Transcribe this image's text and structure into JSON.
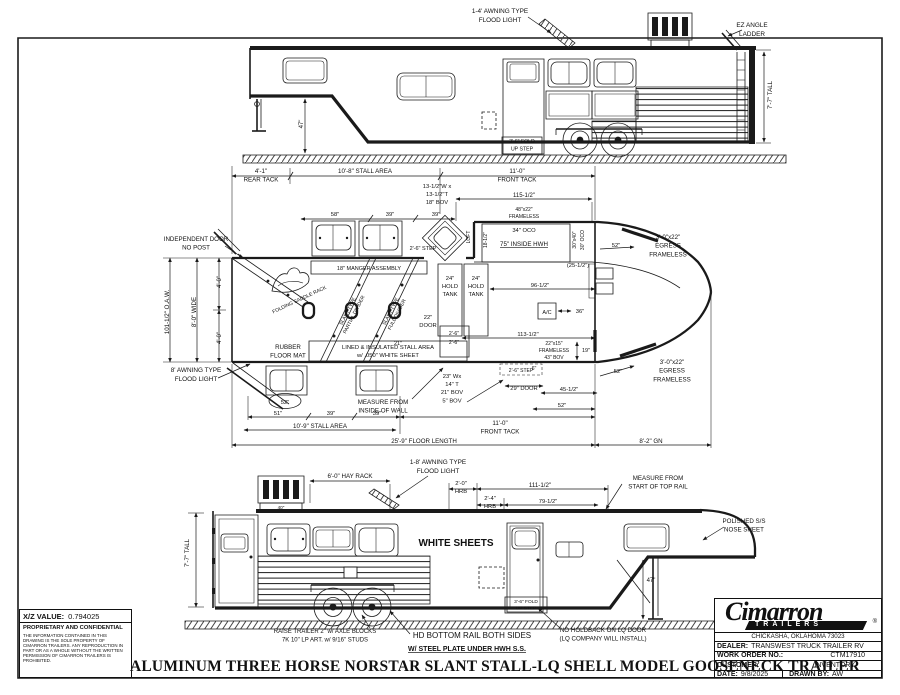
{
  "drawing": {
    "footer_title": "ALUMINUM THREE HORSE NORSTAR SLANT STALL-LQ SHELL MODEL GOOSENECK TRAILER"
  },
  "xz_block": {
    "label": "X/Z VALUE:",
    "value": "0.794025",
    "confidential_title": "PROPRIETARY AND CONFIDENTIAL",
    "confidential_body": "THE INFORMATION CONTAINED IN THIS DRAWING IS THE SOLE PROPERTY OF CIMARRON TRAILERS.  ANY REPRODUCTION IN PART OR AS A WHOLE WITHOUT THE WRITTEN PERMISSION OF CIMARRON TRAILERS IS PROHIBITED."
  },
  "title_block": {
    "brand": "Cimarron",
    "brand_sub": "TRAILERS",
    "registered": "®",
    "address": "CHICKASHA, OKLAHOMA 73023",
    "dealer_label": "DEALER:",
    "dealer": "TRANSWEST TRUCK TRAILER RV",
    "work_order_label": "WORK ORDER NO.:",
    "work_order": "CTM17910",
    "customer_label": "CUSTOMER:",
    "customer": "INVENTORY",
    "date_label": "DATE:",
    "date": "9/8/2025",
    "drawn_by_label": "DRAWN BY:",
    "drawn_by": "AW"
  },
  "annotations": [
    {
      "name": "awning-flood-light-label-top",
      "lines": [
        "1-4' AWNING TYPE",
        "FLOOD LIGHT"
      ],
      "x": 500,
      "y": 13,
      "size": 6.4
    },
    {
      "name": "ez-angle-ladder-label",
      "lines": [
        "EZ ANGLE",
        "LADDER"
      ],
      "x": 752,
      "y": 27,
      "size": 6.4
    },
    {
      "name": "height-dim-top-view",
      "lines": [
        "7'-7\" TALL"
      ],
      "x": 772,
      "y": 95,
      "rot": -90,
      "size": 6.2
    },
    {
      "name": "fold-up-step-label-top-view",
      "lines": [
        "3'-6\" FOLD",
        "UP STEP"
      ],
      "x": 522,
      "y": 143,
      "size": 5.2
    },
    {
      "name": "gooseneck-clearance-dim-top-view",
      "lines": [
        "47\""
      ],
      "x": 303,
      "y": 124,
      "rot": -90,
      "size": 6
    },
    {
      "name": "rear-tack-dim",
      "lines": [
        "4'-1\"",
        "REAR TACK"
      ],
      "x": 261,
      "y": 173,
      "size": 6.2
    },
    {
      "name": "stall-area-dim",
      "lines": [
        "10'-8\" STALL AREA"
      ],
      "x": 365,
      "y": 173,
      "size": 6.2
    },
    {
      "name": "front-tack-dim",
      "lines": [
        "11'-0\"",
        "FRONT TACK"
      ],
      "x": 517,
      "y": 173,
      "size": 6.2
    },
    {
      "name": "loft-window-size-label",
      "lines": [
        "13-1/2\"W x",
        "13-1/2\"T",
        "18\" BOV"
      ],
      "x": 437,
      "y": 188,
      "size": 5.8
    },
    {
      "name": "dim-115-5",
      "lines": [
        "115-1/2\""
      ],
      "x": 524,
      "y": 197,
      "size": 6
    },
    {
      "name": "dim-58",
      "lines": [
        "58\""
      ],
      "x": 335,
      "y": 216,
      "size": 5.8
    },
    {
      "name": "dim-39-a",
      "lines": [
        "39\""
      ],
      "x": 390,
      "y": 216,
      "size": 5.8
    },
    {
      "name": "dim-39-b",
      "lines": [
        "39\""
      ],
      "x": 436,
      "y": 216,
      "size": 5.8
    },
    {
      "name": "hwh-window-label",
      "lines": [
        "48\"x22\"",
        "FRAMELESS"
      ],
      "x": 524,
      "y": 211,
      "size": 5
    },
    {
      "name": "oco-34-label",
      "lines": [
        "34\" OCO"
      ],
      "x": 524,
      "y": 232,
      "size": 5.8
    },
    {
      "name": "inside-hwh-label",
      "lines": [
        "75\" INSIDE HWH"
      ],
      "x": 524,
      "y": 246,
      "size": 6.2,
      "underline": true
    },
    {
      "name": "hwh-right-size-label",
      "lines": [
        "30\"x40\""
      ],
      "x": 576,
      "y": 240,
      "rot": -90,
      "size": 5
    },
    {
      "name": "hwh-right-oco-label",
      "lines": [
        "30\" OCO"
      ],
      "x": 584,
      "y": 240,
      "rot": -90,
      "size": 5
    },
    {
      "name": "hwh-left-size-label",
      "lines": [
        "18-1/2\""
      ],
      "x": 487,
      "y": 240,
      "rot": -90,
      "size": 5
    },
    {
      "name": "loft-label",
      "lines": [
        "LOFT"
      ],
      "x": 470,
      "y": 237,
      "rot": -90,
      "size": 5
    },
    {
      "name": "step-label-plan-top",
      "lines": [
        "2'-6\" STEP"
      ],
      "x": 423,
      "y": 250,
      "size": 5.5
    },
    {
      "name": "dim-25-5",
      "lines": [
        "(25-1/2\")"
      ],
      "x": 578,
      "y": 267,
      "size": 5.8
    },
    {
      "name": "egress-window-label-top",
      "lines": [
        "3'-0\"x22\"",
        "EGRESS",
        "FRAMELESS"
      ],
      "x": 668,
      "y": 239,
      "size": 6.2
    },
    {
      "name": "dim-52-egress-top",
      "lines": [
        "52\""
      ],
      "x": 616,
      "y": 247,
      "size": 5.8
    },
    {
      "name": "independent-door-label",
      "lines": [
        "INDEPENDENT DOOR",
        "NO POST"
      ],
      "x": 196,
      "y": 241,
      "size": 6.2
    },
    {
      "name": "oaw-dim",
      "lines": [
        "101-1/2\" O.A.W."
      ],
      "x": 169,
      "y": 312,
      "rot": -90,
      "size": 6.2
    },
    {
      "name": "wide-dim",
      "lines": [
        "8'-0\" WIDE"
      ],
      "x": 196,
      "y": 312,
      "rot": -90,
      "size": 6.2
    },
    {
      "name": "half-width-dim-a",
      "lines": [
        "4'-0\""
      ],
      "x": 221,
      "y": 282,
      "rot": -90,
      "size": 6
    },
    {
      "name": "half-width-dim-b",
      "lines": [
        "4'-0\""
      ],
      "x": 221,
      "y": 338,
      "rot": -90,
      "size": 6
    },
    {
      "name": "awning-flood-light-label-plan",
      "lines": [
        "8' AWNING TYPE",
        "FLOOD LIGHT"
      ],
      "x": 196,
      "y": 372,
      "size": 6.4
    },
    {
      "name": "manger-assembly-label",
      "lines": [
        "18\" MANGER ASSEMBLY"
      ],
      "x": 369,
      "y": 270,
      "size": 5.5
    },
    {
      "name": "folding-saddle-rack-label",
      "lines": [
        "FOLDING SADDLE RACK"
      ],
      "x": 300,
      "y": 301,
      "rot": -25,
      "size": 5
    },
    {
      "name": "partial-divider-label",
      "lines": [
        "SLANT TYPE",
        "PARTIAL DIVIDER"
      ],
      "x": 349,
      "y": 312,
      "rot": -63,
      "size": 5
    },
    {
      "name": "full-divider-label",
      "lines": [
        "SLANT TYPE",
        "FULL DIVIDER"
      ],
      "x": 392,
      "y": 312,
      "rot": -63,
      "size": 5
    },
    {
      "name": "hold-tank-label-a",
      "lines": [
        "24\"",
        "HOLD",
        "TANK"
      ],
      "x": 450,
      "y": 280,
      "size": 5.8
    },
    {
      "name": "hold-tank-label-b",
      "lines": [
        "24\"",
        "HOLD",
        "TANK"
      ],
      "x": 476,
      "y": 280,
      "size": 5.8
    },
    {
      "name": "door-22-label",
      "lines": [
        "22\"",
        "DOOR"
      ],
      "x": 428,
      "y": 319,
      "size": 5.8
    },
    {
      "name": "closet-dim-a",
      "lines": [
        "2'-6\""
      ],
      "x": 454,
      "y": 335,
      "size": 5.2
    },
    {
      "name": "closet-dim-b",
      "lines": [
        "2'-6\""
      ],
      "x": 454,
      "y": 344,
      "size": 5.2
    },
    {
      "name": "dim-21",
      "lines": [
        "21\""
      ],
      "x": 398,
      "y": 345,
      "size": 5.5
    },
    {
      "name": "ac-label",
      "lines": [
        "A/C"
      ],
      "x": 547,
      "y": 314,
      "size": 5.5
    },
    {
      "name": "dim-36",
      "lines": [
        "36\""
      ],
      "x": 580,
      "y": 313,
      "size": 5.8
    },
    {
      "name": "dim-96-5",
      "lines": [
        "96-1/2\""
      ],
      "x": 540,
      "y": 287,
      "size": 5.8
    },
    {
      "name": "dim-6",
      "lines": [
        "6\""
      ],
      "x": 534,
      "y": 370,
      "size": 5.2
    },
    {
      "name": "rubber-mat-label",
      "lines": [
        "RUBBER",
        "FLOOR MAT"
      ],
      "x": 288,
      "y": 349,
      "size": 6.2
    },
    {
      "name": "lined-insulated-label",
      "lines": [
        "LINED & INSULATED STALL AREA",
        "w/ .050\" WHITE SHEET"
      ],
      "x": 388,
      "y": 349,
      "size": 5.8
    },
    {
      "name": "measure-inside-wall-label",
      "lines": [
        "MEASURE FROM",
        "INSIDE OF WALL"
      ],
      "x": 383,
      "y": 404,
      "size": 6.2
    },
    {
      "name": "dim-52-oval",
      "lines": [
        "52\""
      ],
      "x": 285,
      "y": 404,
      "size": 5.8
    },
    {
      "name": "dim-51",
      "lines": [
        "51\""
      ],
      "x": 278,
      "y": 415,
      "size": 5.8
    },
    {
      "name": "dim-39-c",
      "lines": [
        "39\""
      ],
      "x": 331,
      "y": 415,
      "size": 5.8
    },
    {
      "name": "dim-39-d",
      "lines": [
        "39\""
      ],
      "x": 377,
      "y": 415,
      "size": 5.8
    },
    {
      "name": "stall-area-dim-bottom",
      "lines": [
        "10'-9\" STALL AREA"
      ],
      "x": 320,
      "y": 428,
      "size": 6.2
    },
    {
      "name": "floor-length-dim",
      "lines": [
        "25'-9\" FLOOR LENGTH"
      ],
      "x": 424,
      "y": 443,
      "size": 6.2
    },
    {
      "name": "tack-window-label",
      "lines": [
        "23\" Wx",
        "14\" T",
        "21\" BOV",
        "5\" BOV"
      ],
      "x": 452,
      "y": 378,
      "size": 5.8
    },
    {
      "name": "step-label-plan-bottom",
      "lines": [
        "2'-6\" STEP"
      ],
      "x": 521,
      "y": 372,
      "size": 5
    },
    {
      "name": "door-29-label",
      "lines": [
        "29\" DOOR"
      ],
      "x": 524,
      "y": 390,
      "size": 5.8
    },
    {
      "name": "dim-113-5",
      "lines": [
        "113-1/2\""
      ],
      "x": 528,
      "y": 336,
      "size": 5.8
    },
    {
      "name": "front-window-label",
      "lines": [
        "22\"x15\"",
        "FRAMELESS",
        "43\" BOV"
      ],
      "x": 554,
      "y": 345,
      "size": 5
    },
    {
      "name": "dim-19",
      "lines": [
        "19\""
      ],
      "x": 586,
      "y": 352,
      "size": 5.5
    },
    {
      "name": "dim-45-5",
      "lines": [
        "45-1/2\""
      ],
      "x": 569,
      "y": 391,
      "size": 5.8
    },
    {
      "name": "dim-52-bottom",
      "lines": [
        "52\""
      ],
      "x": 562,
      "y": 407,
      "size": 5.8
    },
    {
      "name": "front-tack-dim-bottom",
      "lines": [
        "11'-0\"",
        "FRONT TACK"
      ],
      "x": 500,
      "y": 425,
      "size": 6.2
    },
    {
      "name": "egress-window-label-bottom",
      "lines": [
        "3'-0\"x22\"",
        "EGRESS",
        "FRAMELESS"
      ],
      "x": 672,
      "y": 364,
      "size": 6.2
    },
    {
      "name": "dim-52-egress-bottom",
      "lines": [
        "52\""
      ],
      "x": 618,
      "y": 373,
      "size": 5.8
    },
    {
      "name": "gooseneck-length-dim",
      "lines": [
        "8'-2\" GN"
      ],
      "x": 651,
      "y": 443,
      "size": 6.2
    },
    {
      "name": "hay-rack-dim",
      "lines": [
        "6'-0\" HAY RACK"
      ],
      "x": 350,
      "y": 478,
      "size": 6.2
    },
    {
      "name": "dim-40",
      "lines": [
        "40\""
      ],
      "x": 281,
      "y": 509,
      "size": 4.6
    },
    {
      "name": "awning-flood-light-label-bottom",
      "lines": [
        "1-8' AWNING TYPE",
        "FLOOD LIGHT"
      ],
      "x": 438,
      "y": 464,
      "size": 6.4
    },
    {
      "name": "hrb-dim-a",
      "lines": [
        "2'-0\"",
        "HRB"
      ],
      "x": 461,
      "y": 485,
      "size": 5.8
    },
    {
      "name": "hrb-dim-b",
      "lines": [
        "2'-4\"",
        "HRB"
      ],
      "x": 490,
      "y": 500,
      "size": 5.8
    },
    {
      "name": "dim-111-5",
      "lines": [
        "111-1/2\""
      ],
      "x": 540,
      "y": 487,
      "size": 6.2
    },
    {
      "name": "dim-79-5",
      "lines": [
        "79-1/2\""
      ],
      "x": 548,
      "y": 503,
      "size": 5.8
    },
    {
      "name": "measure-top-rail-label",
      "lines": [
        "MEASURE FROM",
        "START OF TOP RAIL"
      ],
      "x": 658,
      "y": 480,
      "size": 6.2
    },
    {
      "name": "nose-sheet-label",
      "lines": [
        "POLISHED S/S",
        "NOSE SHEET"
      ],
      "x": 744,
      "y": 523,
      "size": 6.2
    },
    {
      "name": "height-dim-bottom-view",
      "lines": [
        "7'-7\" TALL"
      ],
      "x": 189,
      "y": 553,
      "rot": -90,
      "size": 6.2
    },
    {
      "name": "white-sheets-label",
      "lines": [
        "WHITE SHEETS"
      ],
      "x": 456,
      "y": 546,
      "size": 10,
      "bold": true,
      "serif": true
    },
    {
      "name": "gooseneck-clearance-dim-bottom-view",
      "lines": [
        "47\""
      ],
      "x": 651,
      "y": 582,
      "size": 6
    },
    {
      "name": "fold-up-step-label-bottom-view",
      "lines": [
        "3'-6\" FOLD",
        "UP STEP"
      ],
      "x": 526,
      "y": 603,
      "size": 4.8
    },
    {
      "name": "raise-trailer-note",
      "lines": [
        "RAISE TRAILER 2\" w/ AXLE BLOCKS",
        "7K 10\" LP ART. w/ 9/16\" STUDS"
      ],
      "x": 325,
      "y": 633,
      "size": 6
    },
    {
      "name": "bottom-rail-note",
      "lines": [
        "HD BOTTOM RAIL BOTH SIDES"
      ],
      "x": 472,
      "y": 638,
      "size": 8
    },
    {
      "name": "steel-plate-note",
      "lines": [
        "W/ STEEL PLATE UNDER HWH S.S."
      ],
      "x": 467,
      "y": 651,
      "size": 7,
      "bold": true,
      "underline": true
    },
    {
      "name": "no-holdback-note",
      "lines": [
        "NO HOLDBACK ON LQ DOOR",
        "(LQ COMPANY WILL INSTALL)"
      ],
      "x": 603,
      "y": 632,
      "size": 6.2
    }
  ]
}
